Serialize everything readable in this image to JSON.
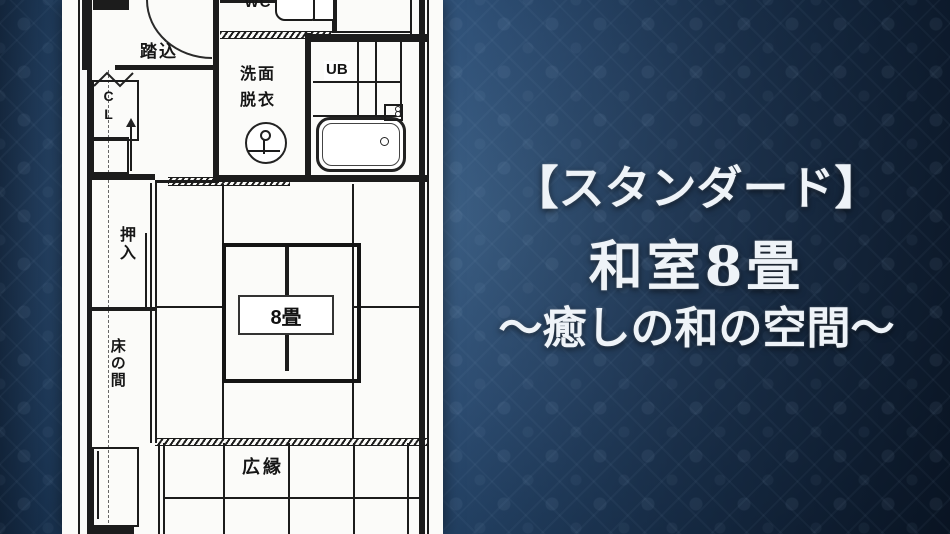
{
  "background": {
    "style": "dark navy damask wallpaper with vignette",
    "base_color": "#31537a",
    "edge_color": "#0a1828"
  },
  "caption": {
    "line1": "【スタンダード】",
    "line2": "和室8畳",
    "line3": "～癒しの和の空間～",
    "text_color": "#eef3f8"
  },
  "floor_plan": {
    "paper_color": "#fbfbf9",
    "line_color": "#1c1c1c",
    "rooms": {
      "wc": "WC",
      "entrance": "踏込",
      "washroom_line1": "洗面",
      "washroom_line2": "脱衣",
      "unit_bath": "UB",
      "closet": "CL",
      "oshiire": "押入",
      "tokonoma": "床の間",
      "tatami_size": "8畳",
      "veranda": "広縁"
    }
  }
}
